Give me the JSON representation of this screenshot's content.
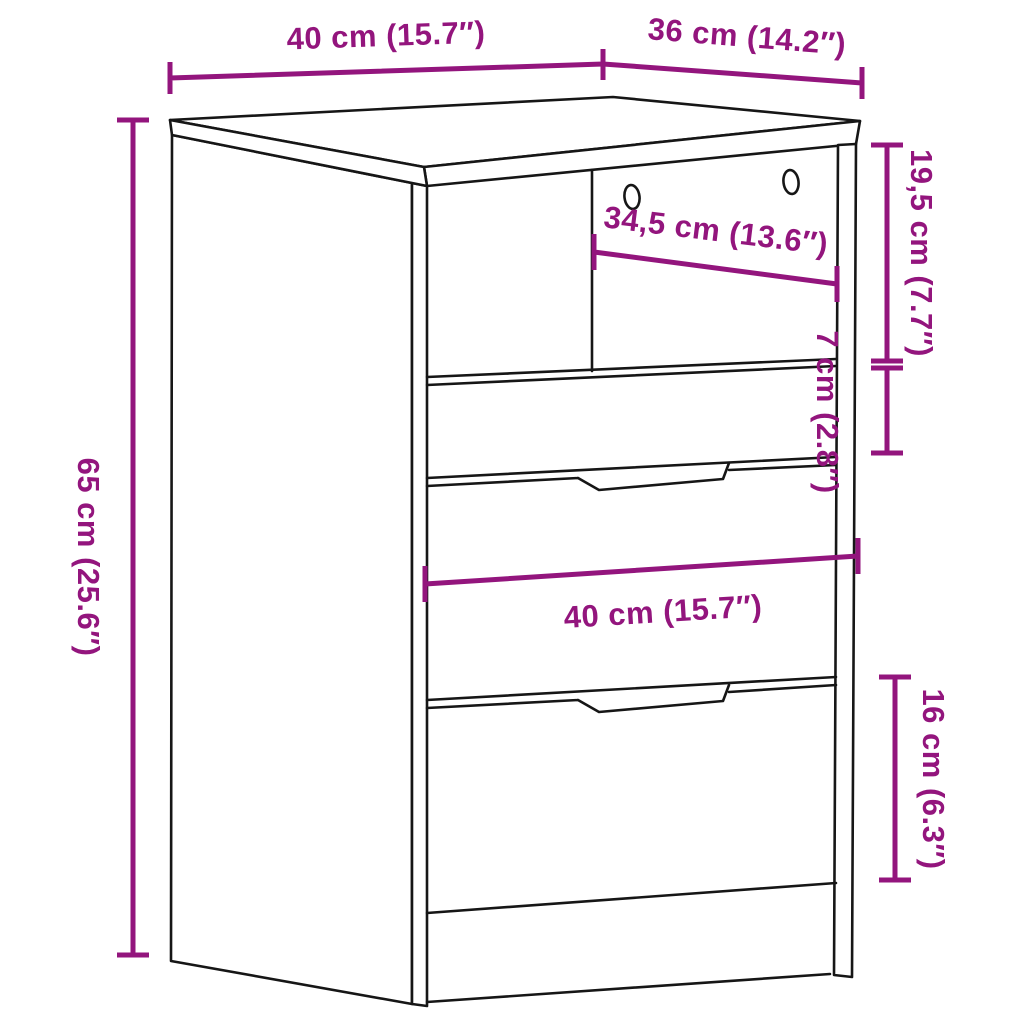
{
  "diagram": {
    "type": "furniture-dimension-drawing",
    "subject": "bedside cabinet with open compartment and three drawers",
    "dim_color": "#93157D",
    "line_color": "#161616",
    "labels": {
      "top_width": "40 cm (15.7″)",
      "top_depth": "36 cm (14.2″)",
      "inner_width": "34,5 cm (13.6″)",
      "overall_height": "65 cm (25.6″)",
      "compartment_height": "19,5 cm (7.7″)",
      "top_drawer_height": "7 cm (2.8″)",
      "drawer_width": "40 cm (15.7″)",
      "bottom_drawer_height": "16 cm (6.3″)"
    }
  }
}
